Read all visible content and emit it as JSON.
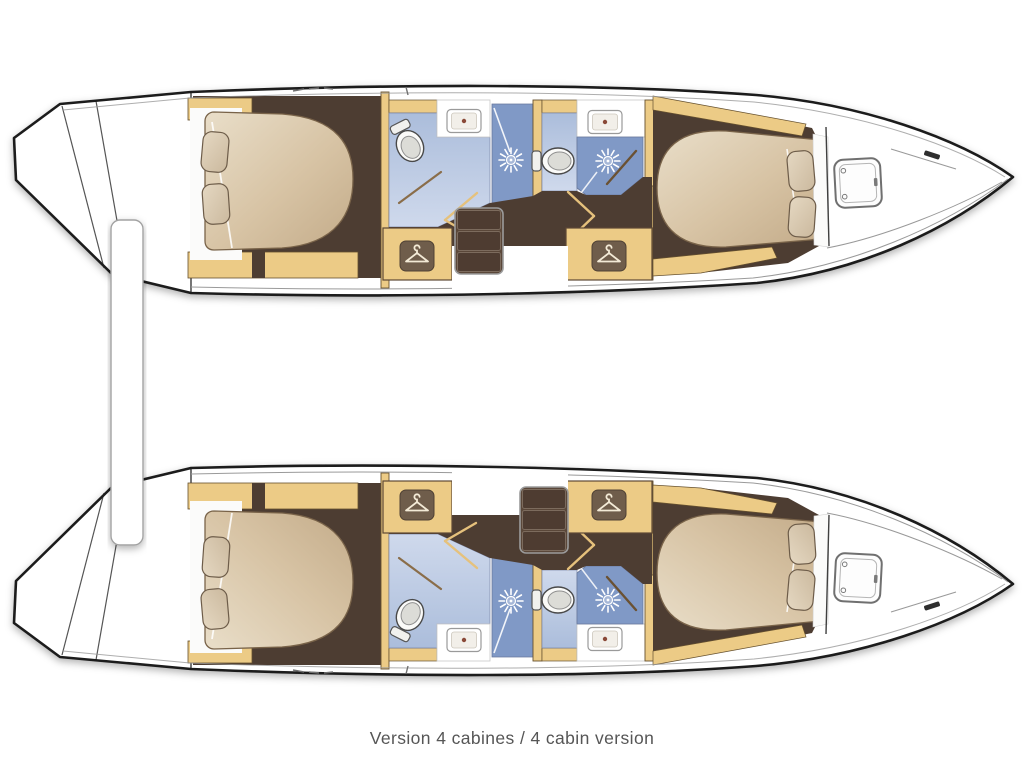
{
  "caption": {
    "text": "Version 4 cabines / 4 cabin version"
  },
  "plan": {
    "type": "catamaran-floor-plan",
    "cabin_count": 4,
    "hulls": [
      {
        "id": "port-hull-top",
        "rooms": [
          {
            "name": "aft-cabin",
            "items": [
              "double-bed",
              "pillow",
              "pillow"
            ]
          },
          {
            "name": "bathroom-1",
            "items": [
              "toilet",
              "washbasin",
              "shower"
            ]
          },
          {
            "name": "bathroom-2",
            "items": [
              "toilet",
              "washbasin",
              "shower"
            ]
          },
          {
            "name": "wardrobe-aft",
            "icon": "hanger-icon"
          },
          {
            "name": "wardrobe-forward",
            "icon": "hanger-icon"
          },
          {
            "name": "companionway-steps",
            "steps": 3
          },
          {
            "name": "forward-cabin",
            "items": [
              "double-bed",
              "pillow",
              "pillow",
              "deck-hatch"
            ]
          }
        ]
      },
      {
        "id": "starboard-hull-bottom",
        "rooms": [
          {
            "name": "aft-cabin",
            "items": [
              "double-bed",
              "pillow",
              "pillow"
            ]
          },
          {
            "name": "bathroom-1",
            "items": [
              "toilet",
              "washbasin",
              "shower"
            ]
          },
          {
            "name": "bathroom-2",
            "items": [
              "toilet",
              "washbasin",
              "shower"
            ]
          },
          {
            "name": "wardrobe-aft",
            "icon": "hanger-icon"
          },
          {
            "name": "wardrobe-forward",
            "icon": "hanger-icon"
          },
          {
            "name": "companionway-steps",
            "steps": 3
          },
          {
            "name": "forward-cabin",
            "items": [
              "double-bed",
              "pillow",
              "pillow",
              "deck-hatch"
            ]
          }
        ]
      }
    ],
    "colors": {
      "hull_outline": "#1c1c1c",
      "wood_trim": "#eccb86",
      "cabin_floor": "#4e3c31",
      "bed": "#d7c5aa",
      "pillow": "#dccfb8",
      "bathroom_floor": "#b7c5e0",
      "shower_floor": "#8099c6",
      "hanger_plaque": "#6f5d4b",
      "caption_text": "#565656"
    }
  }
}
